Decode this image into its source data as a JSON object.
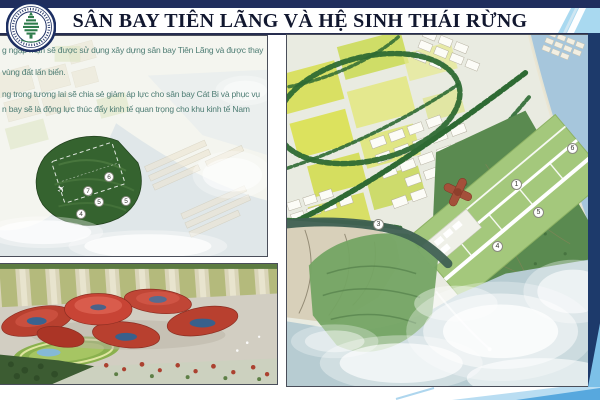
{
  "colors": {
    "top_bar_navy": "#202e5e",
    "title_text": "#11172f",
    "body_text_teal": "#4e7d74",
    "panel_border": "#4a4e5a",
    "accent_light_blue": "#a9d9f0",
    "accent_medium_blue": "#57a8de",
    "right_band_navy": "#1d3a6b",
    "terminal_red": "#b8402f",
    "plan_green": "#5a8a50"
  },
  "header": {
    "title": "SÂN BAY TIÊN LÃNG VÀ HỆ SINH THÁI RỪNG",
    "logo": "city-tree-emblem"
  },
  "intro_text": {
    "lines": [
      "g ngập mặn sẽ được sử dụng xây dựng sân bay Tiên Lãng và được thay",
      "vùng đất lấn biển.",
      "ng trong tương lai sẽ chia sẻ giảm áp lực cho sân bay Cát Bi và phục vụ",
      "n bay sẽ là động lực thúc đẩy kinh tế quan trọng cho khu kinh tế Nam"
    ]
  },
  "site_map": {
    "markers": [
      "6",
      "7",
      "5",
      "4",
      "5"
    ],
    "plane_icon": "✈"
  },
  "master_plan": {
    "markers": [
      "1",
      "6",
      "5",
      "4",
      "3"
    ]
  }
}
